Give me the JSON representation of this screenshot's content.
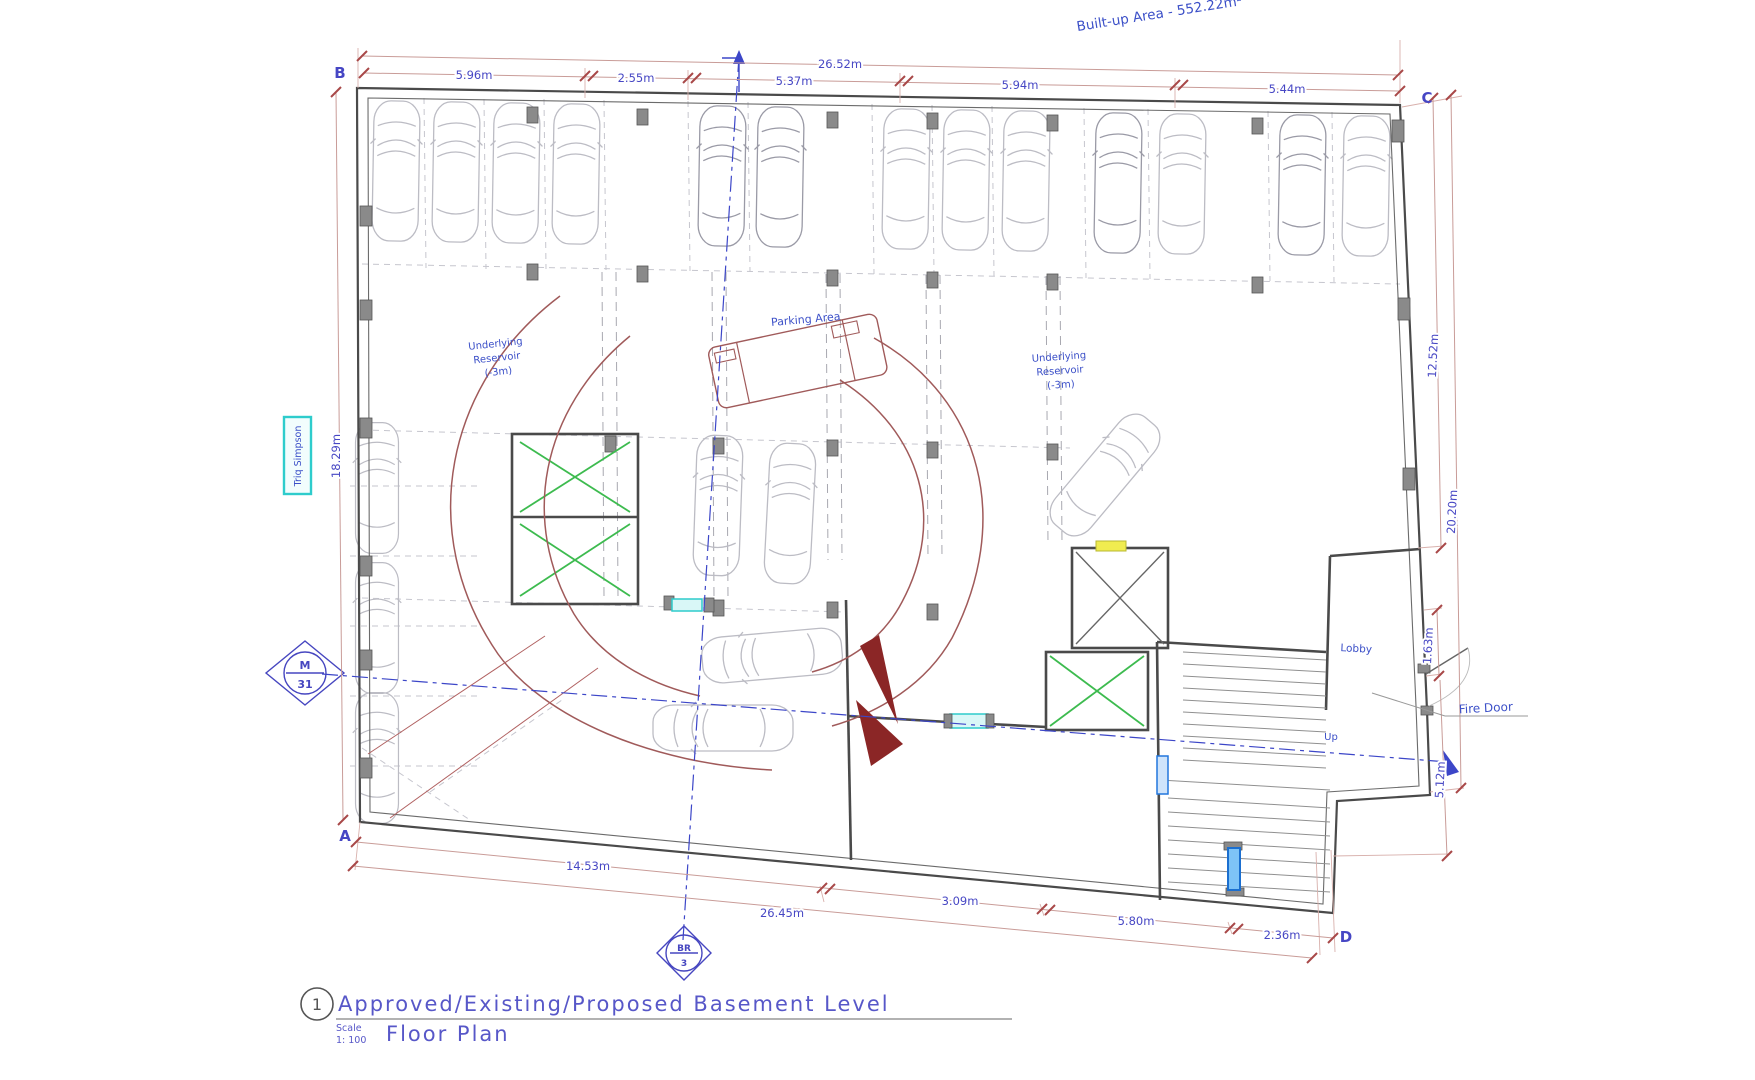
{
  "annotations": {
    "built_up_area": "Built-up Area - 552.22m²"
  },
  "grid": {
    "a": "A",
    "b": "B",
    "c": "C",
    "d": "D"
  },
  "dims": {
    "top_total": "26.52m",
    "top_seg_1": "5.96m",
    "top_seg_2": "2.55m",
    "top_seg_3": "5.37m",
    "top_seg_4": "5.94m",
    "top_seg_5": "5.44m",
    "left_height": "18.29m",
    "right_upper": "12.52m",
    "right_mid": "20.20m",
    "right_lobby": "1.63m",
    "right_lower": "5.12m",
    "bottom_inner": "14.53m",
    "bottom_total": "26.45m",
    "bottom_seg_1": "3.09m",
    "bottom_seg_2": "5.80m",
    "bottom_seg_3": "2.36m"
  },
  "labels": {
    "street": "Triq Simpson",
    "parking_area": "Parking Area",
    "reservoir_line_1": "Underlying",
    "reservoir_line_2": "Reservoir",
    "reservoir_line_3": "(-3m)",
    "lobby": "Lobby",
    "fire_door": "Fire Door",
    "up": "Up"
  },
  "section_markers": {
    "left_top": "M",
    "left_bottom": "31",
    "bottom_top": "BR",
    "bottom_bottom": "3"
  },
  "title_block": {
    "sheet_number": "1",
    "title": "Approved/Existing/Proposed Basement Level",
    "subtitle": "Floor Plan",
    "scale_label": "Scale",
    "scale_value": "1: 100"
  },
  "colors": {
    "dimension_text": "#4747c4",
    "dimension_line": "#c99c98",
    "tick": "#a84848",
    "wall": "#4a4a4a",
    "car_outline": "#bcbcc4",
    "label_blue": "#3c50c8",
    "green_x": "#3dbb4f",
    "section_blue": "#3c46c8",
    "street_box_cyan": "#2ecccc",
    "door_blue": "#1b6fd0",
    "shaft_yellow": "#f0ec50",
    "turning_arc": "#a05a5a",
    "ramp_wedge": "#8b2626",
    "title_blue": "#5757c8"
  }
}
